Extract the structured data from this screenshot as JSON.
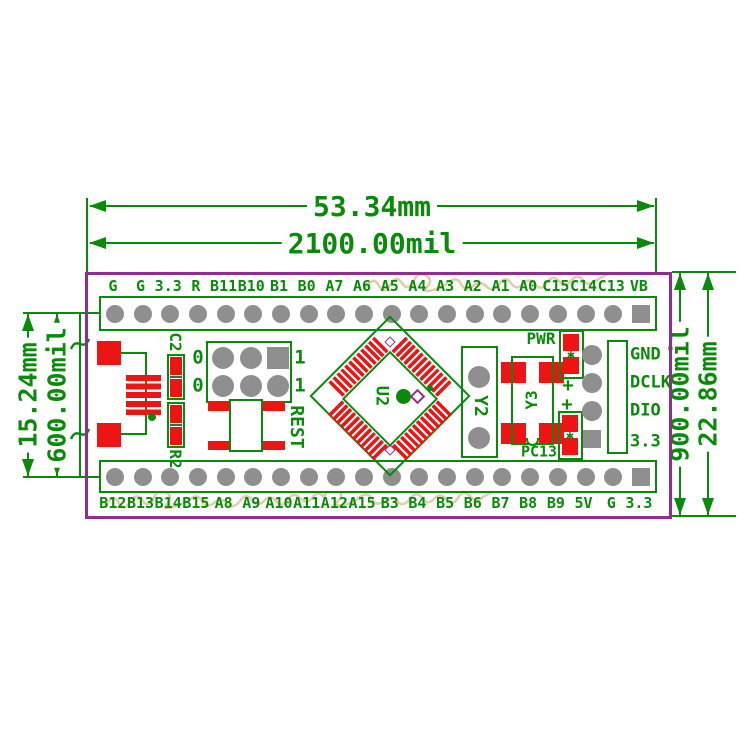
{
  "dimensions": {
    "top_mm": "53.34mm",
    "top_mil": "2100.00mil",
    "left_mm": "15.24mm",
    "left_mil": "600.00mil",
    "right_mil": "900.00mil",
    "right_mm": "22.86mm"
  },
  "board": {
    "top_pin_labels": [
      "G",
      "G",
      "3.3",
      "R",
      "B11",
      "B10",
      "B1",
      "B0",
      "A7",
      "A6",
      "A5",
      "A4",
      "A3",
      "A2",
      "A1",
      "A0",
      "C15",
      "C14",
      "C13",
      "VB"
    ],
    "bottom_pin_labels": [
      "B12",
      "B13",
      "B14",
      "B15",
      "A8",
      "A9",
      "A10",
      "A11",
      "A12",
      "A15",
      "B3",
      "B4",
      "B5",
      "B6",
      "B7",
      "B8",
      "B9",
      "5V",
      "G",
      "3.3"
    ],
    "components": {
      "c2": "C2",
      "r2": "R2",
      "rest_button": "REST",
      "mcu": "U2",
      "crystal_y2": "Y2",
      "crystal_y3": "Y3",
      "pwr_led": "PWR",
      "pc13_led": "PC13",
      "led_star": "✱",
      "plus_marks": [
        "+",
        "+"
      ],
      "boot_jumper_left": [
        "0",
        "0"
      ],
      "boot_jumper_right": [
        "1",
        "1"
      ],
      "swd_labels": [
        "GND",
        "DCLK",
        "DIO",
        "3.3"
      ]
    }
  },
  "colors": {
    "silkscreen_green": "#0a8a0a",
    "board_outline_purple": "#8e2f8e",
    "pad_red": "#ee1414",
    "hole_gray": "#8f8f8f",
    "watermark_tan": "#d9c79c",
    "background": "#ffffff"
  }
}
